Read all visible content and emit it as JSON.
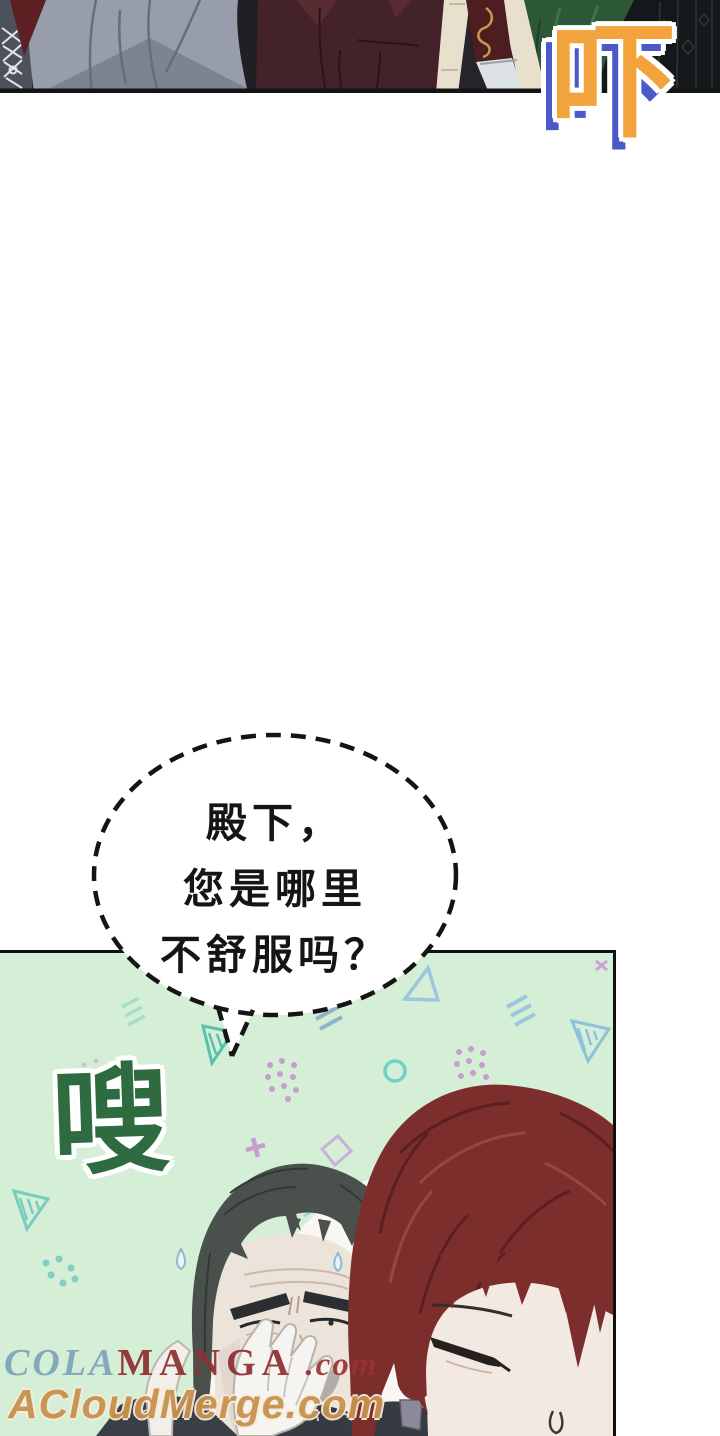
{
  "page": {
    "width": 720,
    "height": 1436,
    "background": "#ffffff"
  },
  "top_panel": {
    "description": "cropped dark scene of standing figures",
    "colors": {
      "jacket_gray": "#979daa",
      "coat_maroon": "#44222a",
      "strap_cream": "#e8e0cc",
      "scabbard_red": "#4e1d20",
      "blade_silver": "#dde2e6",
      "sleeve_green": "#2c5837",
      "fabric_dark": "#14181a"
    }
  },
  "sfx": {
    "startle": {
      "text": "吓",
      "fill": "#f3a33c",
      "shadow": "#4a58c8",
      "outline": "#ffffff"
    },
    "whoosh": {
      "text": "嗖",
      "fill": "#2e6b40",
      "outline": "#ffffff"
    }
  },
  "speech_bubble": {
    "lines": [
      "殿下，",
      "您是哪里",
      "不舒服吗？"
    ],
    "text_color": "#151515",
    "border_color": "#141414",
    "fill": "#ffffff",
    "border_style": "dashed"
  },
  "green_panel": {
    "background": "#d4efd6",
    "border": "#101010",
    "deco_colors": {
      "triangle_blue": "#9cc6de",
      "triangle_teal": "#58c0ae",
      "dots_purple": "#c89bd2",
      "dots_teal": "#7fd0c2",
      "circle_teal": "#6fd3c3",
      "square_lilac": "#c9b2da"
    }
  },
  "characters": {
    "old_man": {
      "hair": "#4a514c",
      "skin": "#ece3db",
      "beard": "#b2aca6",
      "glove": "#f6f4f1"
    },
    "red_haired": {
      "hair": "#7c2e2d",
      "skin": "#f2e9e2"
    }
  },
  "watermarks": {
    "line1": {
      "part1": "COLA",
      "part2": "MANGA",
      "part3": " .com",
      "color_part1": "#7fa3bc",
      "color_part2": "#8e2f33"
    },
    "line2": {
      "text": "ACloudMerge.com",
      "color": "#c8924e"
    }
  }
}
